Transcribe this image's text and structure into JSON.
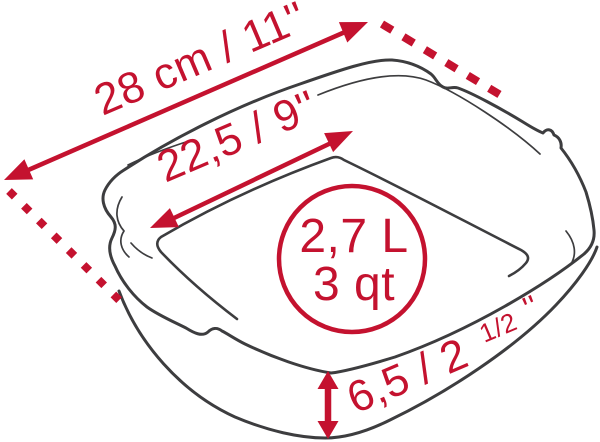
{
  "diagram": {
    "subject": "square baking dish dimension diagram",
    "colors": {
      "accent_red": "#c4122f",
      "line_dark": "#3d3d3f",
      "background": "#ffffff"
    },
    "measurements": {
      "outer_width": {
        "label": "28 cm / 11''"
      },
      "inner_width": {
        "label": "22,5 / 9''"
      },
      "capacity": {
        "liters": "2,7 L",
        "quarts": "3 qt"
      },
      "height": {
        "main": "6,5 / 2",
        "fraction": "1/2",
        "suffix": "''"
      }
    }
  }
}
